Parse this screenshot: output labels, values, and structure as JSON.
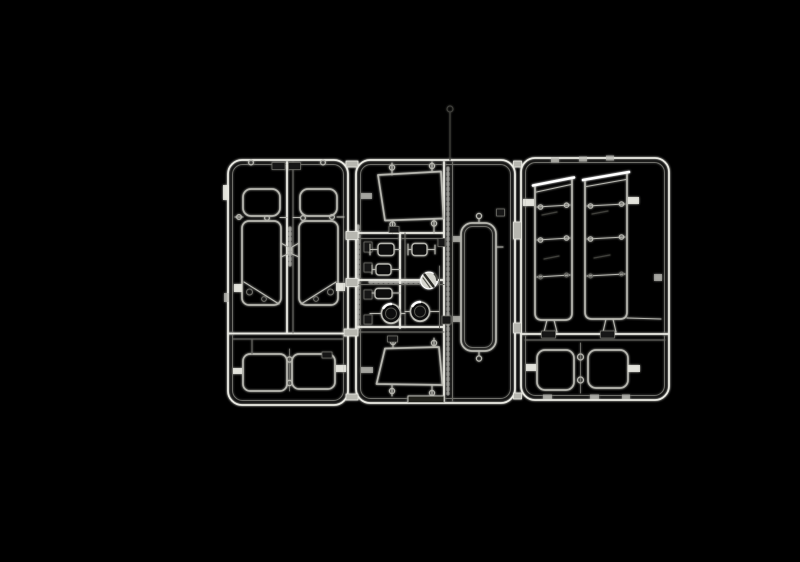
{
  "figure": {
    "alt": "Photograph of a clear transparent plastic model-kit sprue (parts tree) with window glazing and lens parts, lit against a pure black background"
  },
  "colors": {
    "background": "#000000",
    "dim": "#6d6d68",
    "mid": "#b7b7b0",
    "bright": "#e9e9e2",
    "highlight": "#ffffff",
    "plate": "#191914",
    "lens": "#0a0a0a",
    "faint": "#3f3f3b"
  },
  "sprue": {
    "finish": "clear transparent",
    "frames": [
      {
        "id": "frame-left",
        "parts": [
          "door-window-left",
          "door-window-right",
          "twin-pane-window-lower"
        ]
      },
      {
        "id": "frame-middle",
        "parts": [
          "trapezoid-window-upper",
          "lens-bracket-row-1-left",
          "lens-bracket-row-1-right",
          "lens-bracket-row-2",
          "lens-bracket-row-3",
          "faceted-round-lens",
          "dome-lens-left",
          "dome-lens-right",
          "tall-rounded-panel",
          "trapezoid-window-lower"
        ]
      },
      {
        "id": "frame-right",
        "parts": [
          "segmented-side-window-left",
          "segmented-side-window-right",
          "twin-pane-window-lower"
        ]
      }
    ],
    "part_number_tags": "small molded tags present, digits not legible"
  }
}
